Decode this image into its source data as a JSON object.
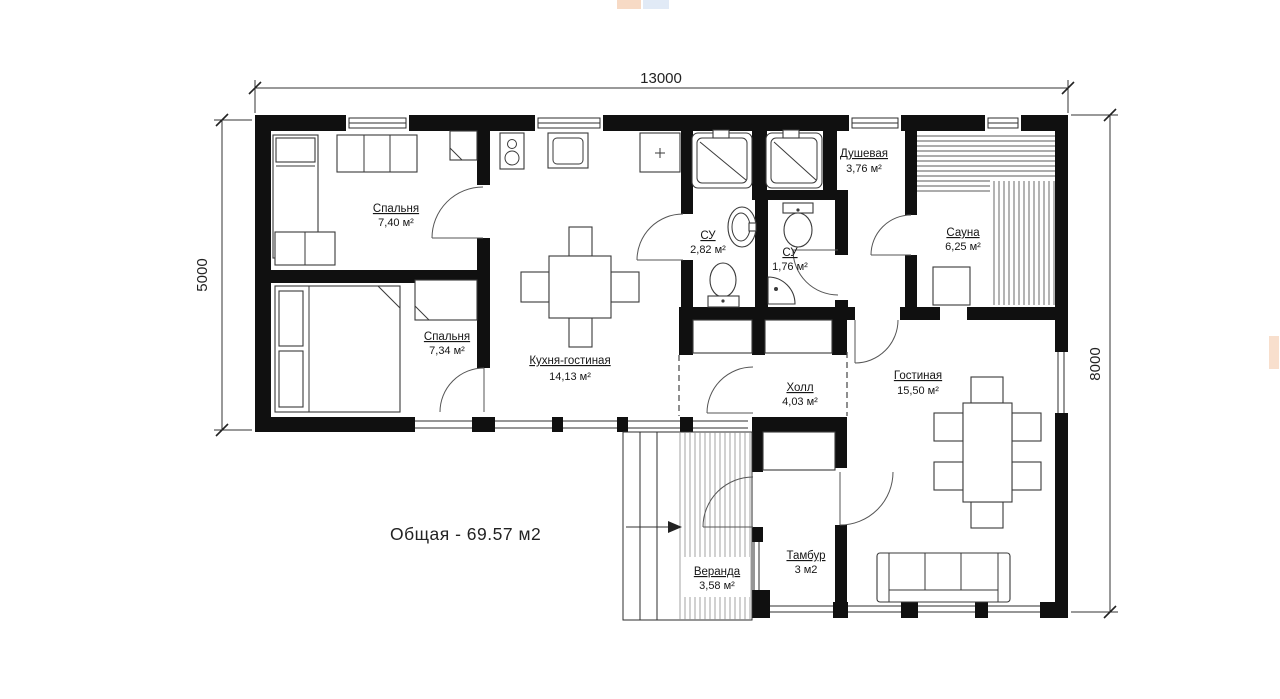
{
  "plan": {
    "total_area": "Общая - 69.57 м2",
    "dimensions": {
      "top": "13000",
      "left": "5000",
      "right": "8000"
    },
    "rooms": {
      "bedroom1": {
        "name": "Спальня",
        "area": "7,40 м²"
      },
      "bedroom2": {
        "name": "Спальня",
        "area": "7,34 м²"
      },
      "kitchen_living": {
        "name": "Кухня-гостиная",
        "area": "14,13 м²"
      },
      "bathroom1": {
        "name": "СУ",
        "area": "2,82 м²"
      },
      "bathroom2": {
        "name": "СУ",
        "area": "1,76 м²"
      },
      "shower_room": {
        "name": "Душевая",
        "area": "3,76 м²"
      },
      "sauna": {
        "name": "Сауна",
        "area": "6,25 м²"
      },
      "hall": {
        "name": "Холл",
        "area": "4,03 м²"
      },
      "living_room": {
        "name": "Гостиная",
        "area": "15,50 м²"
      },
      "veranda": {
        "name": "Веранда",
        "area": "3,58 м²"
      },
      "vestibule": {
        "name": "Тамбур",
        "area": "3 м2"
      }
    }
  }
}
